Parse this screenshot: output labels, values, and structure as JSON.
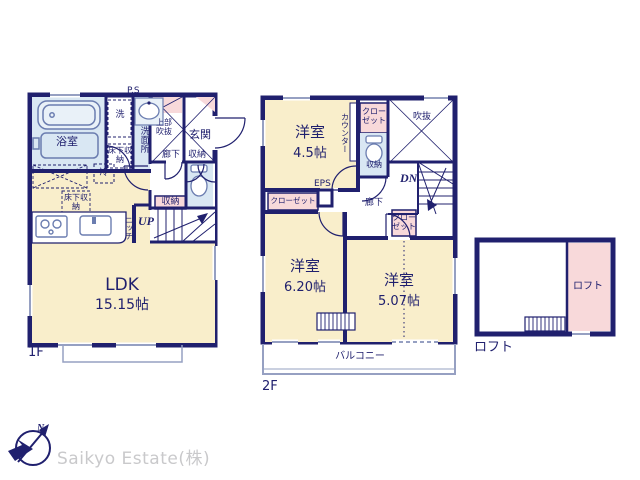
{
  "palette": {
    "wall_navy": "#20206e",
    "room_cream": "#f9eecb",
    "wet_blue": "#d9e7f3",
    "closet_pink": "#f8d9da",
    "window_gray": "#96a0c2",
    "logo_gray": "#c9c9cb"
  },
  "f1": {
    "caption": "1F",
    "ps": "P.S",
    "bath": "浴室",
    "washer": "洗",
    "underfloor1": "床下収納",
    "washroom": "洗面所",
    "upper_void": "上部吹抜",
    "entrance": "玄関",
    "hall": "廊下",
    "storage_entrance": "収納",
    "fridge": "冷",
    "underfloor2": "床下収納",
    "niche": "ニッチ",
    "up": "UP",
    "storage_hall": "収納",
    "ldk": "LDK",
    "ldk_size": "15.15帖"
  },
  "f2": {
    "caption": "2F",
    "room1": "洋室",
    "room1_size": "4.5帖",
    "closet_top": "クローゼット",
    "counter": "カウンター",
    "toilet_storage": "収納",
    "void": "吹抜",
    "dn": "DN",
    "eps": "EPS",
    "closet_left": "クローゼット",
    "hall": "廊下",
    "closet_mid": "クローゼット",
    "room2": "洋室",
    "room2_size": "6.20帖",
    "room3": "洋室",
    "room3_size": "5.07帖",
    "balcony": "バルコニー"
  },
  "loft": {
    "room": "ロフト",
    "caption": "ロフト"
  },
  "footer": {
    "north": "N",
    "company": "Saikyo Estate(株)"
  }
}
